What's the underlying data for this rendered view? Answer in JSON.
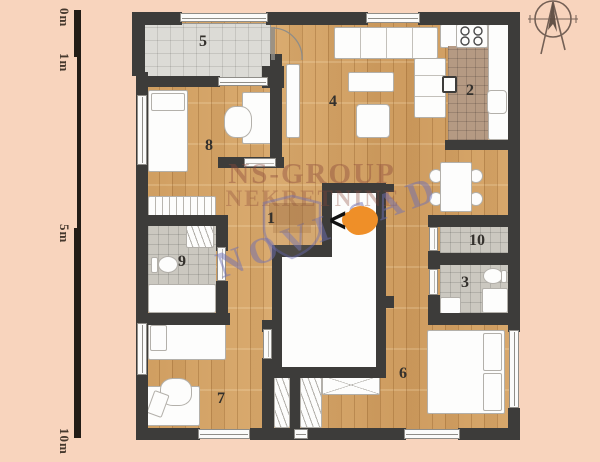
{
  "scale_ruler": {
    "labels": [
      "0m",
      "1m",
      "5m",
      "10m"
    ]
  },
  "rooms": {
    "r1": "1",
    "r2": "2",
    "r3": "3",
    "r4": "4",
    "r5": "5",
    "r6": "6",
    "r7": "7",
    "r8": "8",
    "r9": "9",
    "r10": "10"
  },
  "watermark": {
    "line1": "NS-GROUP",
    "line2": "NEKRETNINE",
    "line3": "NOVI SAD"
  },
  "entrance": {
    "symbol": "<"
  },
  "colors": {
    "background": "#f8d4bd",
    "wall": "#3d3c3a",
    "wood_floor": "#d6a76c",
    "balcony_tile": "#dcdbd6",
    "bath_tile": "#cbc8c0",
    "counter_tile": "#b59a83",
    "entrance_highlight": "#ef8f28",
    "watermark_red": "#8d4a3c",
    "watermark_blue": "#6f6fb4"
  }
}
